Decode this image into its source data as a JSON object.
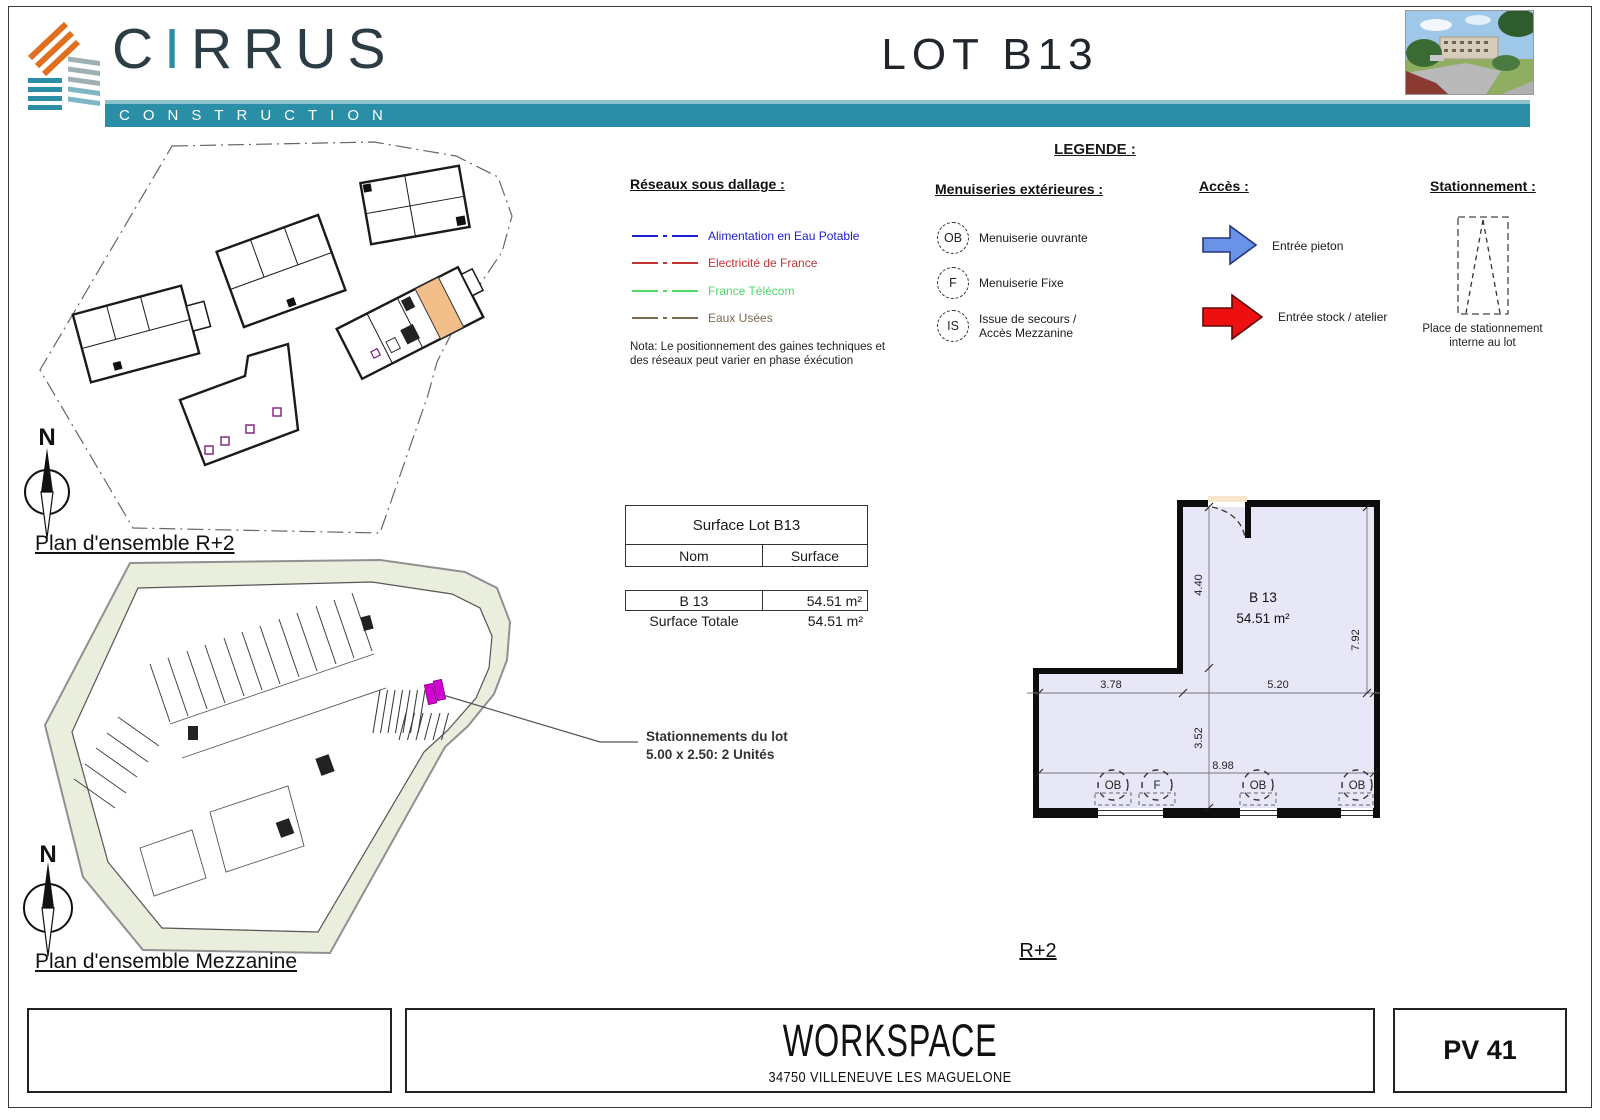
{
  "header": {
    "brand_c": "C",
    "brand_i": "I",
    "brand_rest": "RRUS",
    "brand_sub": "CONSTRUCTION",
    "sheet_title": "LOT B13"
  },
  "legend": {
    "title": "LEGENDE :",
    "reseaux": {
      "heading": "Réseaux sous dallage :",
      "items": [
        {
          "label": "Alimentation en Eau Potable",
          "color": "#2020cc"
        },
        {
          "label": "Electricité de France",
          "color": "#c23535"
        },
        {
          "label": "France Télécom",
          "color": "#4fd96b"
        },
        {
          "label": "Eaux Usées",
          "color": "#7b6a4f"
        }
      ],
      "nota_line1": "Nota: Le positionnement des gaines techniques et",
      "nota_line2": "des réseaux peut varier en phase éxécution"
    },
    "menuiseries": {
      "heading": "Menuiseries extérieures :",
      "items": [
        {
          "symbol": "OB",
          "label": "Menuiserie ouvrante",
          "label2": ""
        },
        {
          "symbol": "F",
          "label": "Menuiserie Fixe",
          "label2": ""
        },
        {
          "symbol": "IS",
          "label": "Issue de secours /",
          "label2": "Accès Mezzanine"
        }
      ]
    },
    "acces": {
      "heading": "Accès :",
      "items": [
        {
          "label": "Entrée pieton",
          "color": "#6a93e8",
          "border": "#24357f"
        },
        {
          "label": "Entrée stock / atelier",
          "color": "#ee1010",
          "border": "#5e0a0a"
        }
      ]
    },
    "stationnement": {
      "heading": "Stationnement :",
      "caption_line1": "Place de stationnement",
      "caption_line2": "interne au lot"
    }
  },
  "plans": {
    "r2_label": "Plan d'ensemble R+2",
    "mezzanine_label": "Plan d'ensemble Mezzanine",
    "compass": "N",
    "parking_note_line1": "Stationnements du lot",
    "parking_note_line2": "5.00 x 2.50: 2 Unités",
    "detail_floor_label": "R+2"
  },
  "surface_table": {
    "title": "Surface Lot B13",
    "col_name": "Nom",
    "col_surface": "Surface",
    "row_name": "B 13",
    "row_surface": "54.51 m²",
    "total_label": "Surface Totale",
    "total_value": "54.51 m²"
  },
  "detail_plan": {
    "unit": "B 13",
    "area": "54.51 m²",
    "dim_top_height": "4.40",
    "dim_left_width": "3.78",
    "dim_right_width": "5.20",
    "dim_lower_height": "3.52",
    "dim_total_width": "8.98",
    "dim_right_height": "7.92",
    "openings": [
      "OB",
      "F",
      "OB",
      "OB"
    ]
  },
  "footer": {
    "project": "WORKSPACE",
    "address": "34750 VILLENEUVE LES MAGUELONE",
    "sheet_code": "PV 41"
  },
  "colors": {
    "teal": "#2a8fa6",
    "room_fill": "#e7e7f7",
    "highlight_orange": "#f2be8a",
    "highlight_magenta": "#d400d4",
    "site_green": "#e9efdc"
  }
}
